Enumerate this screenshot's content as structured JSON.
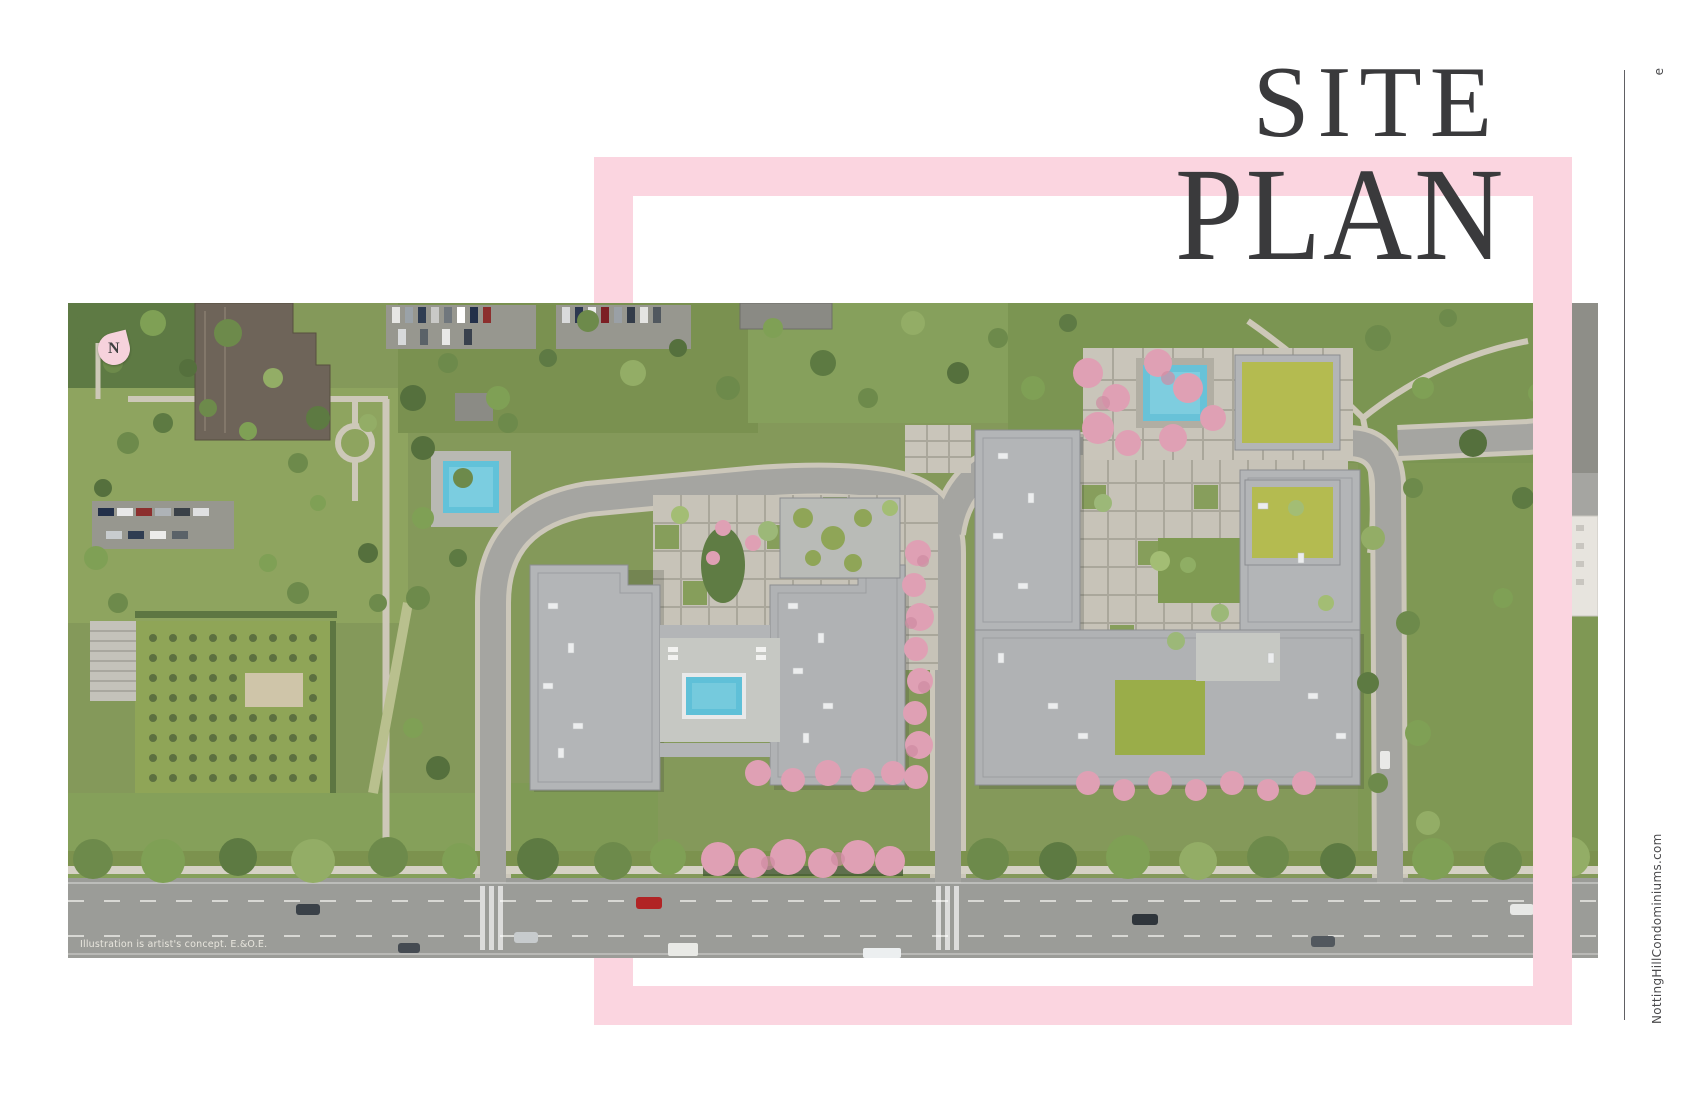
{
  "page": {
    "title": {
      "line1": "SITE",
      "line2": "PLAN"
    },
    "margin": {
      "page_marker": "e",
      "website": "NottingHillCondominiums.com"
    },
    "site_plan": {
      "north_label": "N",
      "disclaimer": "Illustration is artist's concept. E.&O.E."
    }
  },
  "colors": {
    "frame_pink": "#fbd5e0",
    "title_charcoal": "#3a3a3c",
    "blossom_pink": "#dfa0b4",
    "pool_blue": "#5fc0d8",
    "grass_green": "#84995a",
    "asphalt_gray": "#9b9c98"
  }
}
